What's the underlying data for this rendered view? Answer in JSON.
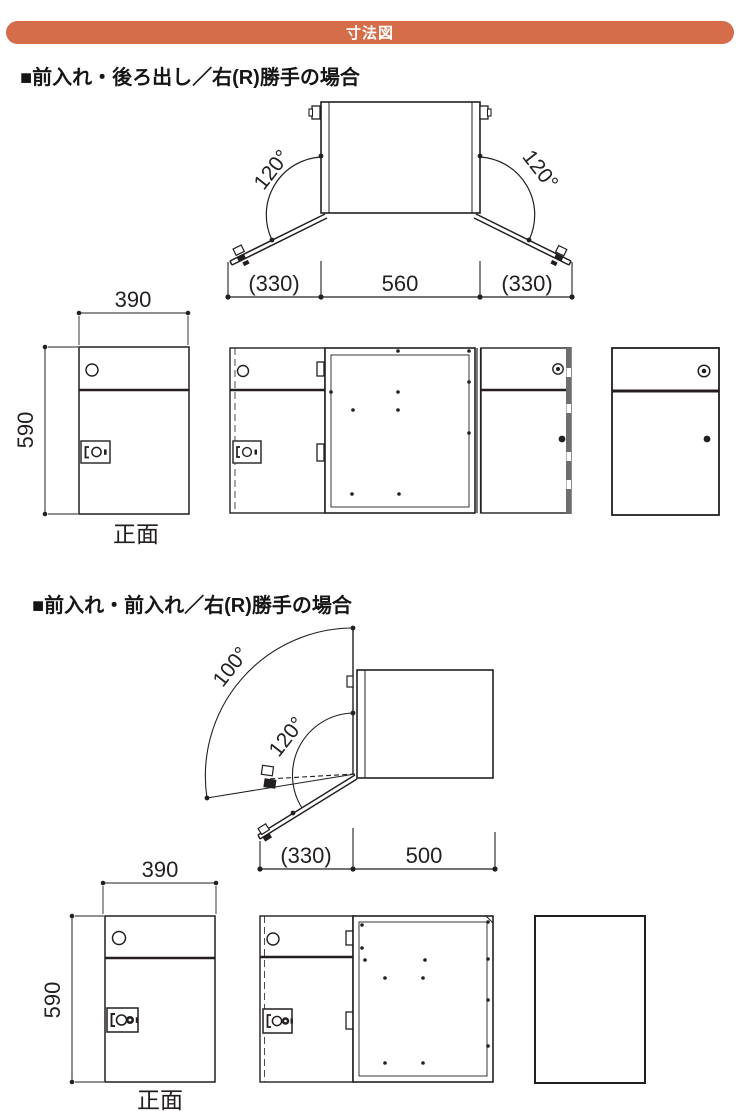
{
  "header": {
    "title": "寸法図"
  },
  "colors": {
    "accent": "#d56c4a",
    "line": "#231f20",
    "panel_gray": "#6e6e6e"
  },
  "sections": [
    {
      "title": "■前入れ・後ろ出し／右(R)勝手の場合",
      "plan": {
        "angle_left": "120°",
        "angle_right": "120°",
        "dims": {
          "left": "(330)",
          "center": "560",
          "right": "(330)"
        }
      },
      "front": {
        "width": "390",
        "height": "590",
        "caption": "正面"
      }
    },
    {
      "title": "■前入れ・前入れ／右(R)勝手の場合",
      "plan": {
        "angle_outer": "100°",
        "angle_inner": "120°",
        "dims": {
          "left": "(330)",
          "right": "500"
        }
      },
      "front": {
        "width": "390",
        "height": "590",
        "caption": "正面"
      }
    }
  ]
}
